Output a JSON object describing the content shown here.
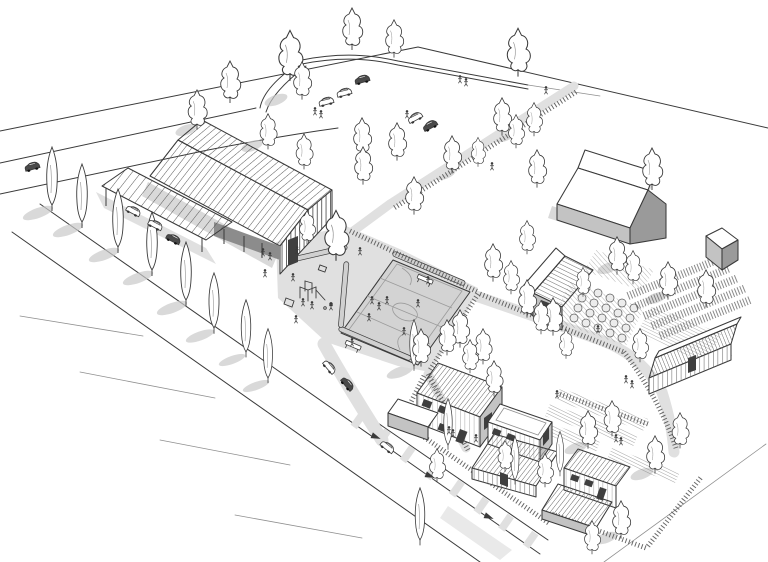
{
  "meta": {
    "description": "Hand-drawn axonometric architectural site illustration in black ink with grey washes: a community farm site with a long timber barn and carport, existing grey farm barn, sports court and playground square, orchard and crop fields, allotment gardens, a cluster of timber houses, perimeter streets lined with poplars, parked cars and sketched people.",
    "style": "grayscale ink sketch"
  },
  "colors": {
    "background": "#ffffff",
    "ink": "#3a3a3a",
    "ink2": "#585858",
    "ink-faint": "#8f8f8f",
    "paving": "#e0e0e0",
    "court": "#d3d3d3",
    "shadow": "#c9c9c9",
    "wall-mid": "#c3c3c3",
    "wall-dark": "#9a9a9a",
    "win-dark": "#3f3f3f",
    "roof-white": "#ffffff"
  },
  "legend": [
    {
      "id": "community-barn",
      "label": "long timber barn with striped roof, slatted gable and carport canopy over parked cars"
    },
    {
      "id": "existing-barn",
      "label": "large grey gabled farm barn"
    },
    {
      "id": "storage-shed",
      "label": "small grey shed"
    },
    {
      "id": "field-barn",
      "label": "gabled field barn with grey walls and seamed roof"
    },
    {
      "id": "long-field-barn",
      "label": "long striped agricultural barn"
    },
    {
      "id": "houses",
      "label": "cluster of timber houses with seamed roofs and flat-roof garages"
    },
    {
      "id": "sports-court",
      "label": "paved multi-sport court with line markings, benches and log seats"
    },
    {
      "id": "playground",
      "label": "playground with climbing frame beside the court"
    },
    {
      "id": "orchard",
      "label": "grid of fruit bushes on hatched ground"
    },
    {
      "id": "crop-fields",
      "label": "hatched crop rows and vineyard scribbles"
    },
    {
      "id": "allotments",
      "label": "allotment garden beds behind the houses"
    },
    {
      "id": "streets",
      "label": "perimeter streets with poplar rows, parking bays and black direction arrows"
    },
    {
      "id": "paths",
      "label": "grey pedestrian paths linking square, orchard and houses"
    },
    {
      "id": "landscape",
      "label": "sketched trees, hedges, shadows and tiny people"
    }
  ]
}
